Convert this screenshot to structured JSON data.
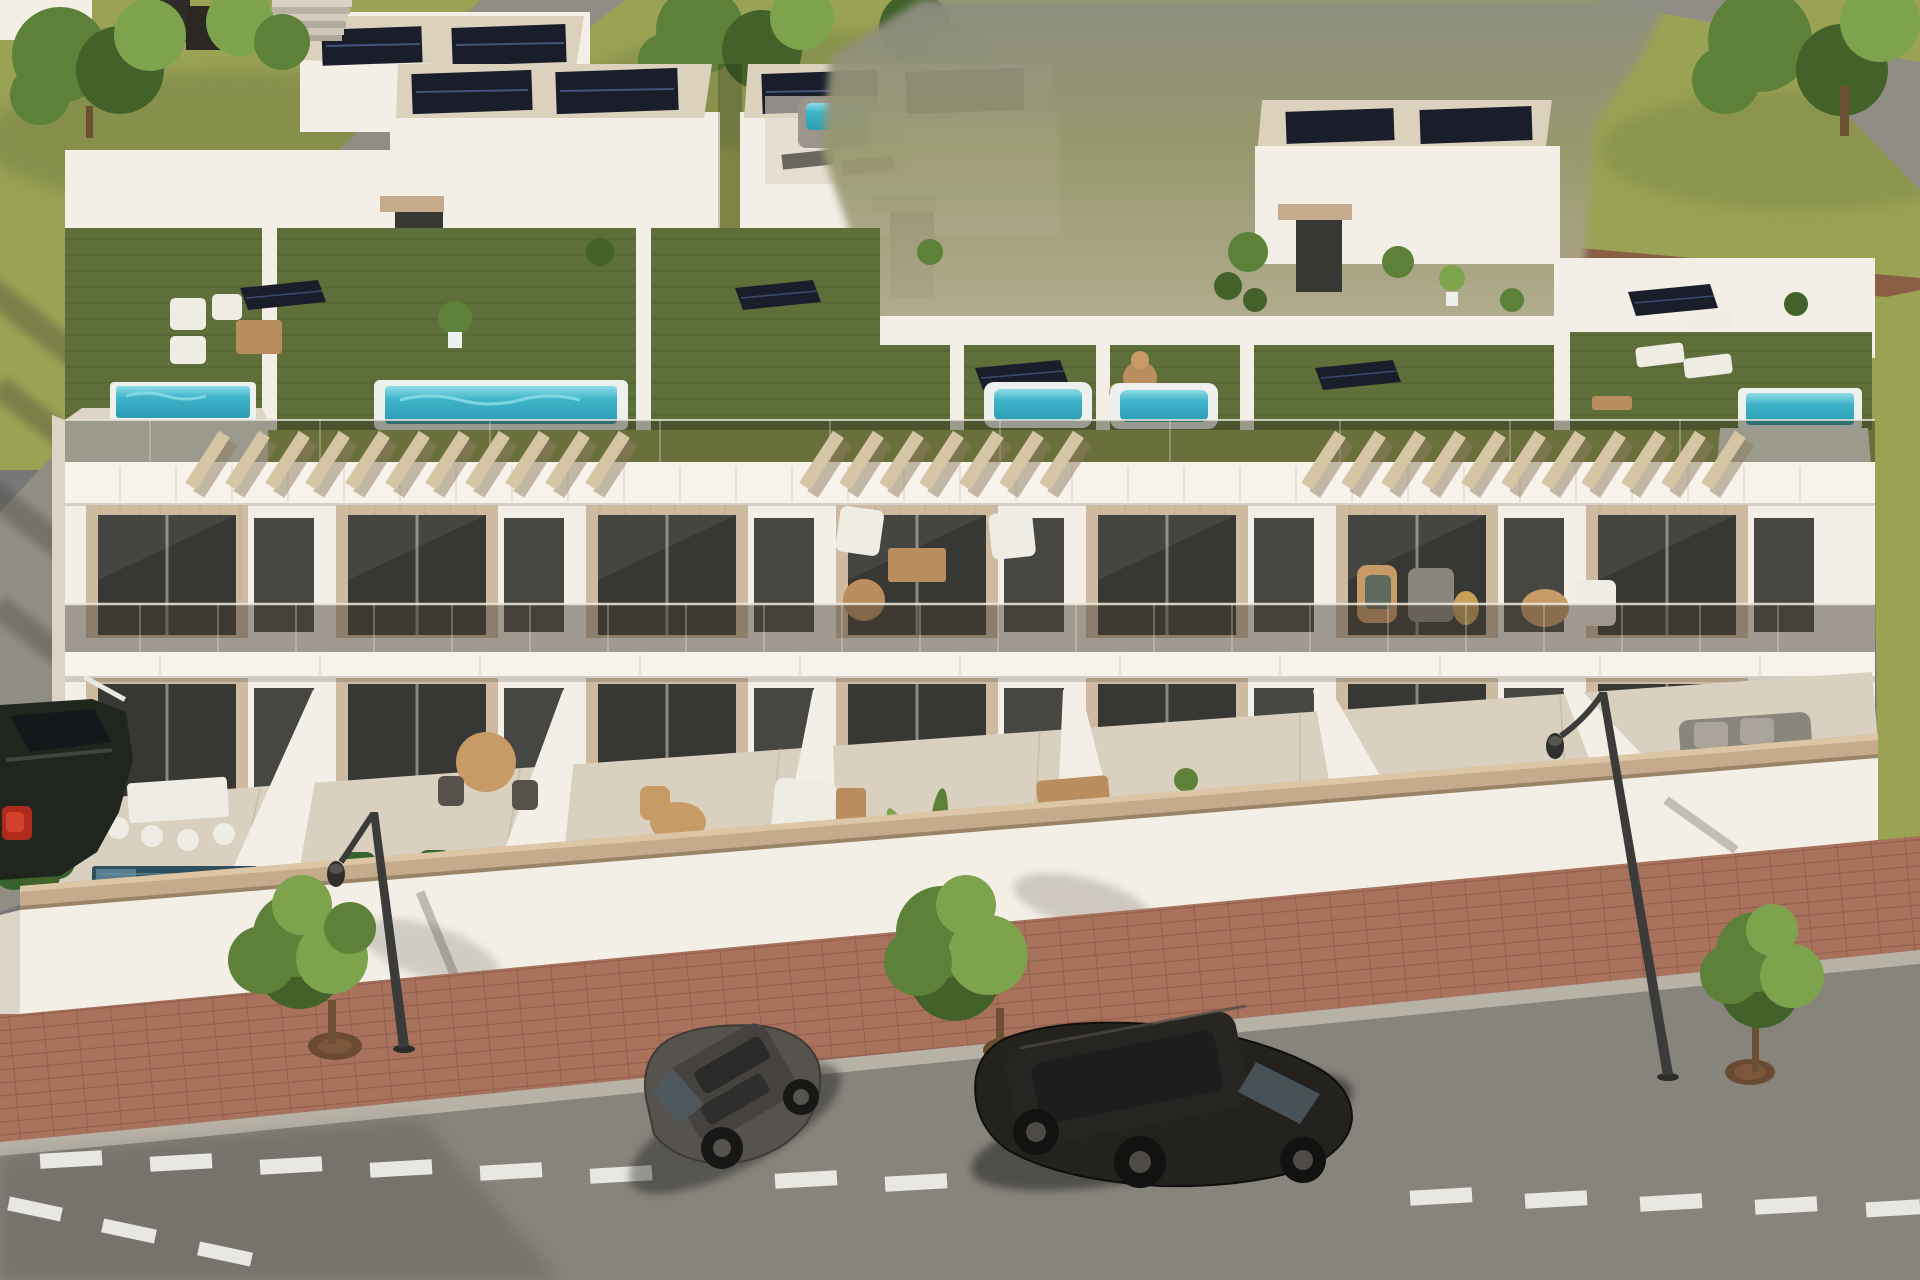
{
  "scene": {
    "type": "architectural-3d-render",
    "view": "aerial-front",
    "subject": "row of modern white townhouses with rooftop terraces, balconies and street parking",
    "objects": {
      "main_building": {
        "floors_visible": 3,
        "rooftop": {
          "surface": "artificial-grass",
          "pools": 5,
          "hot_tubs_background": 1,
          "solar_panel_arrays": 5,
          "pergolas": 3,
          "furniture": [
            "white-sofa-set",
            "wood-coffee-table",
            "sun-loungers",
            "round-dining-table",
            "rattan-chairs",
            "potted-plants"
          ]
        },
        "balcony_level": {
          "balustrade": "tinted-glass",
          "cladding": "light-timber-panels",
          "doors": "anthracite-glass-sliders",
          "furniture": [
            "white-armchairs",
            "round-wood-table",
            "rattan-chair",
            "side-tables"
          ]
        },
        "ground_level": {
          "terraces": 6,
          "plunge_pools": 5,
          "furniture": [
            "white-dining-set",
            "round-rattan-table",
            "white-sofa",
            "wood-dining-table",
            "gray-sofa"
          ],
          "plants": [
            "banana-plants",
            "hedges",
            "flowering-shrubs",
            "palms"
          ]
        }
      },
      "street": {
        "sidewalk": "red-brick-pavers",
        "street_trees": 3,
        "street_lamps": 2,
        "lane_marking": "white-dashed-line",
        "parked_cars": [
          {
            "label": "partial-car-left-edge",
            "color_name": "dark-green-black",
            "detail": "red-taillight"
          },
          {
            "label": "hatchback",
            "color_name": "gray"
          },
          {
            "label": "suv-wagon",
            "color_name": "black"
          }
        ]
      },
      "background": {
        "lawns": true,
        "access_roads": 2,
        "dirt_strip": true,
        "neighbor_building_with_stairs": true,
        "solar_panels_on_roofs": true,
        "trees": 6,
        "blurred_region_top_right": true
      }
    }
  },
  "palette": {
    "lawn": "#9aa254",
    "lawnShade": "#6f7c42",
    "roadMain": "#87847c",
    "roadTop": "#908d85",
    "sidewalk": "#a9725c",
    "sidewalkLine": "#935f4c",
    "curb": "#b7b1a6",
    "wallWhite": "#f3eee6",
    "wallShade": "#ddd4c6",
    "fasciaWhite": "#f7f2ea",
    "gravelRoof": "#dbd1bd",
    "woodPanel": "#cdbaa0",
    "woodGrain": "#b5a084",
    "glassDark": "#373734",
    "frameDark": "#56524b",
    "rooftopGrass": "#5f6f3a",
    "rooftopGrassLight": "#6e7e45",
    "poolWater": "#3fb4c9",
    "poolWaterLight": "#8fdde8",
    "poolRim": "#eef0ee",
    "plungePool": "#2e4f5d",
    "solarDark": "#1a1e2b",
    "solarLine": "#44547a",
    "pergola": "#d6c5a5",
    "pergolaShadow": "#8e7d60",
    "capWood": "#c5ab8c",
    "treeGreen": "#5d8138",
    "treeGreenDark": "#42622a",
    "treeGreenLight": "#7da34d",
    "trunk": "#6d4f33",
    "carGray": "#56524d",
    "carBlack": "#23221f",
    "carWindow": "#4e5a61",
    "taillight": "#b02a1b",
    "lampPost": "#3b3b39",
    "laneMark": "#e9e7e1",
    "dirtPath": "#8a5f46",
    "terraceTile": "#d9d0bf",
    "furnWhite": "#efece4",
    "furnWood": "#b98d5e",
    "rattan": "#c79a66",
    "sofaGray": "#8a857d",
    "hedgeGreen": "#35622d",
    "blurPatchTop": "#8d8d82",
    "blurPatchMid": "#98986f",
    "blurPatchLow": "#b5ae94"
  }
}
